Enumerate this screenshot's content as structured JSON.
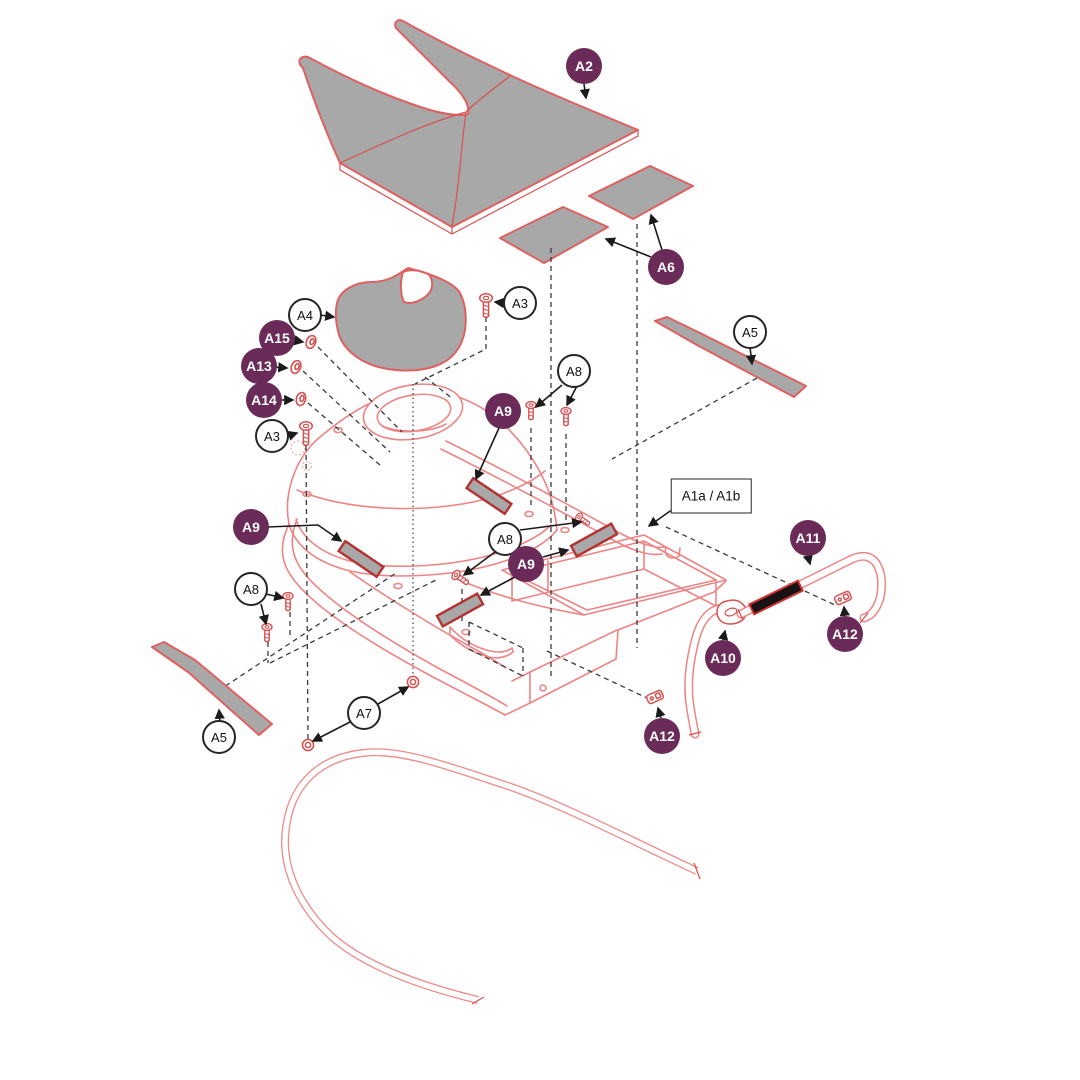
{
  "callouts": [
    {
      "label": "A2",
      "type": "purple"
    },
    {
      "label": "A6",
      "type": "purple"
    },
    {
      "label": "A4",
      "type": "white"
    },
    {
      "label": "A3",
      "type": "white"
    },
    {
      "label": "A15",
      "type": "purple"
    },
    {
      "label": "A13",
      "type": "purple"
    },
    {
      "label": "A14",
      "type": "purple"
    },
    {
      "label": "A3",
      "type": "white"
    },
    {
      "label": "A9",
      "type": "purple"
    },
    {
      "label": "A8",
      "type": "white"
    },
    {
      "label": "A5",
      "type": "white"
    },
    {
      "label": "A9",
      "type": "purple"
    },
    {
      "label": "A8",
      "type": "white"
    },
    {
      "label": "A9",
      "type": "purple"
    },
    {
      "label": "A8",
      "type": "white"
    },
    {
      "label": "A7",
      "type": "white"
    },
    {
      "label": "A5",
      "type": "white"
    },
    {
      "label": "A11",
      "type": "purple"
    },
    {
      "label": "A12",
      "type": "purple"
    },
    {
      "label": "A10",
      "type": "purple"
    },
    {
      "label": "A12",
      "type": "purple"
    },
    {
      "label": "A1a / A1b",
      "type": "box"
    }
  ],
  "colors": {
    "badge_purple": "#6b2b58",
    "line_salmon": "#ee8484",
    "part_red": "#d84f4f",
    "part_gray": "#a8a8a8",
    "strip_border": "#b43232",
    "leader_black": "#3b3b3b",
    "patch_black": "#181212"
  }
}
